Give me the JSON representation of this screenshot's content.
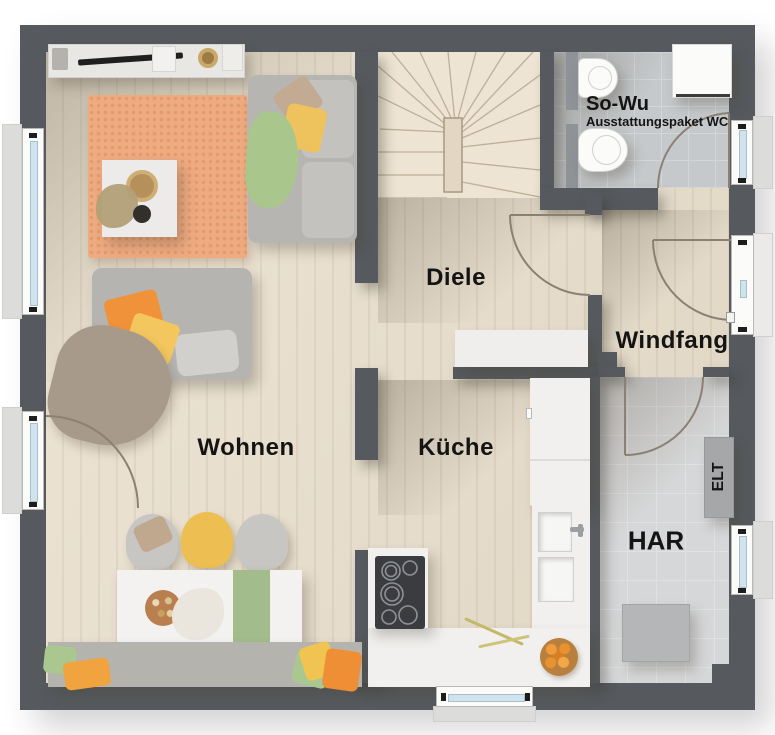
{
  "rooms": {
    "wohnen": {
      "label": "Wohnen"
    },
    "diele": {
      "label": "Diele"
    },
    "kueche": {
      "label": "Küche"
    },
    "windfang": {
      "label": "Windfang"
    },
    "har": {
      "label": "HAR"
    },
    "wc": {
      "label": "So-Wu",
      "sublabel": "Ausstattungspaket WC"
    },
    "elt": {
      "label": "ELT"
    }
  },
  "palette": {
    "wall": "#565a5e",
    "wood_floor": "#e5dbc9",
    "wc_tile": "#c6c9cb",
    "har_tile": "#d6d7d8",
    "rug_orange": "#eeab80",
    "accent_orange": "#ef9136",
    "accent_yellow": "#f1c452",
    "accent_green": "#a9c78e",
    "sofa_gray": "#b7b5b1",
    "counter_white": "#f1f0ee",
    "window_glass": "#cfe3ee"
  }
}
